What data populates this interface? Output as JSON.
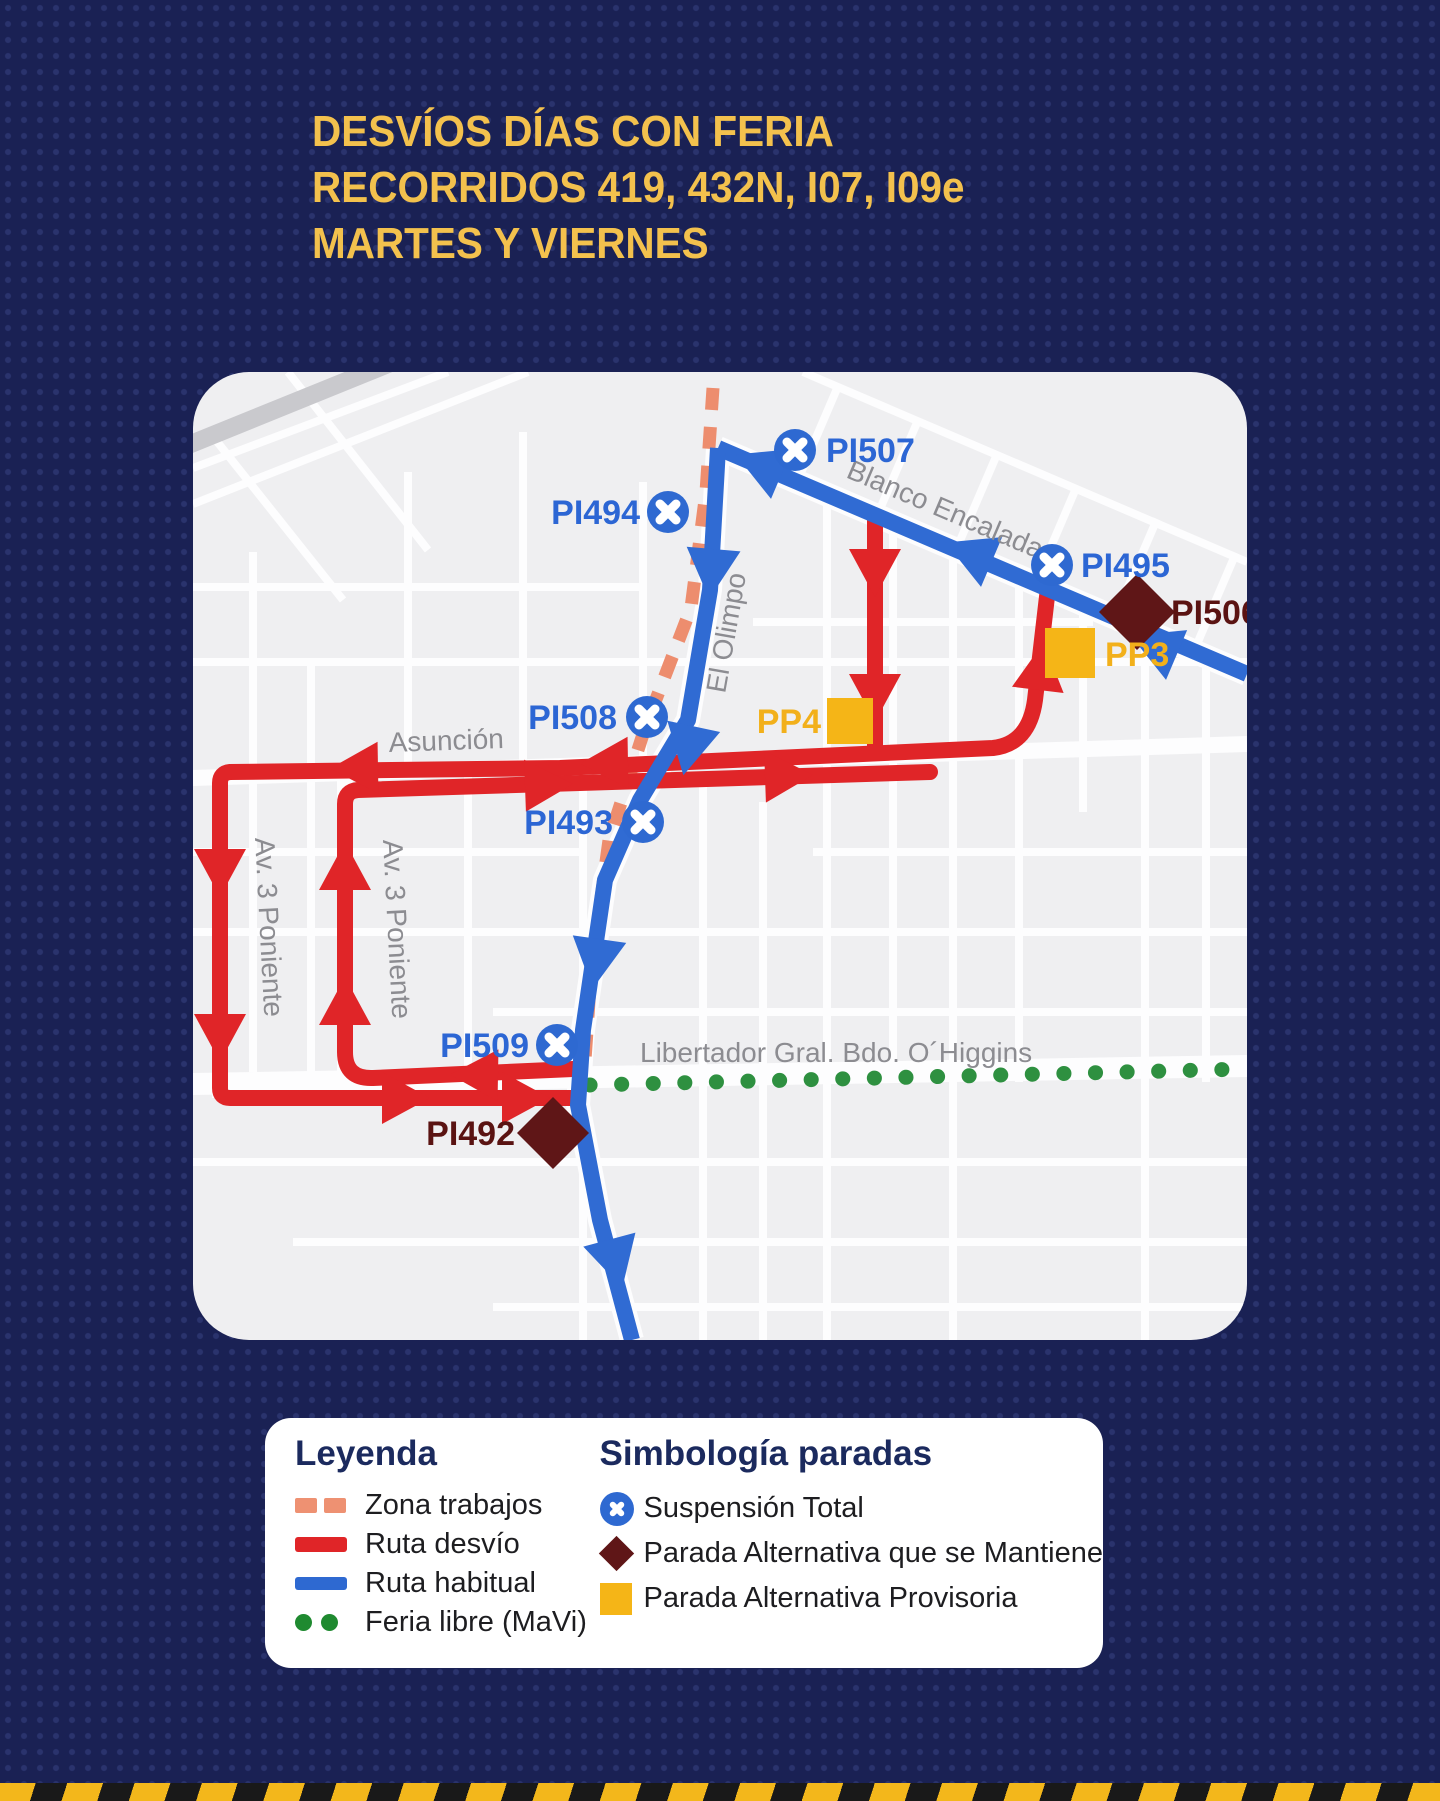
{
  "title": {
    "line1": "DESVÍOS DÍAS CON FERIA",
    "line2": "RECORRIDOS 419, 432N, I07, I09e",
    "line3": "MARTES Y VIERNES"
  },
  "colors": {
    "background_navy": "#1a2154",
    "title_yellow": "#f3c14d",
    "route_habitual_blue": "#306bd3",
    "route_detour_red": "#e02528",
    "work_zone_salmon": "#ed8d6e",
    "feria_green": "#2e9040",
    "stop_suspension_blue": "#2e69d1",
    "stop_maintained_maroon": "#5f1617",
    "stop_provisional_yellow": "#f5b517",
    "map_background": "#efeff1"
  },
  "map": {
    "streets": {
      "blanco_encalada": "Blanco Encalada",
      "el_olimpo": "El Olimpo",
      "asuncion": "Asunción",
      "av3_poniente_west": "Av. 3 Poniente",
      "av3_poniente_east": "Av. 3 Poniente",
      "libertador": "Libertador Gral. Bdo. O´Higgins"
    },
    "stops": [
      {
        "id": "PI507",
        "type": "suspension-total"
      },
      {
        "id": "PI494",
        "type": "suspension-total"
      },
      {
        "id": "PI495",
        "type": "suspension-total"
      },
      {
        "id": "PI506",
        "type": "parada-alternativa-mantiene"
      },
      {
        "id": "PP3",
        "type": "parada-alternativa-provisoria"
      },
      {
        "id": "PP4",
        "type": "parada-alternativa-provisoria"
      },
      {
        "id": "PI508",
        "type": "suspension-total"
      },
      {
        "id": "PI493",
        "type": "suspension-total"
      },
      {
        "id": "PI509",
        "type": "suspension-total"
      },
      {
        "id": "PI492",
        "type": "parada-alternativa-mantiene"
      }
    ]
  },
  "legend": {
    "title": "Leyenda",
    "items": [
      {
        "label": "Zona trabajos",
        "swatch": "salmon-dashes"
      },
      {
        "label": "Ruta desvío",
        "swatch": "red-line"
      },
      {
        "label": "Ruta habitual",
        "swatch": "blue-line"
      },
      {
        "label": "Feria libre (MaVi)",
        "swatch": "green-dots"
      }
    ]
  },
  "symbology": {
    "title": "Simbología paradas",
    "items": [
      {
        "label": "Suspensión Total",
        "icon": "blue-circle-x"
      },
      {
        "label": "Parada Alternativa que se Mantiene",
        "icon": "maroon-diamond"
      },
      {
        "label": "Parada Alternativa Provisoria",
        "icon": "yellow-square"
      }
    ]
  }
}
